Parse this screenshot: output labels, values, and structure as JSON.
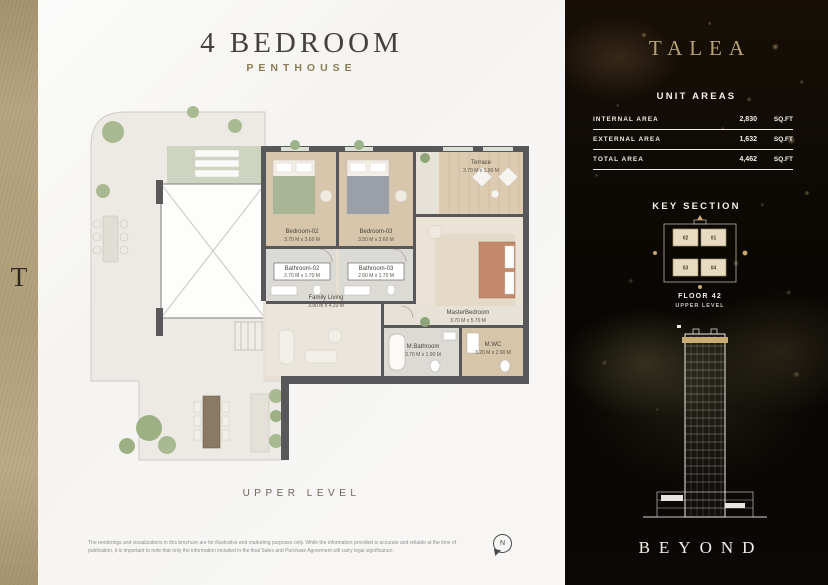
{
  "strip": {
    "letter": "T"
  },
  "main": {
    "title": "4 BEDROOM",
    "subtitle": "PENTHOUSE",
    "level_label": "UPPER LEVEL",
    "compass_label": "N",
    "disclaimer": "The renderings and visualizations in this brochure are for illustrative and marketing purposes only. While the information provided is accurate and reliable at the time of publication, it is important to note that only the information included in the final Sales and Purchase Agreement will carry legal significance."
  },
  "floor_plan": {
    "rooms": [
      {
        "name": "Terrace",
        "dims": "3.70 M x 1.90 M"
      },
      {
        "name": "Bedroom-02",
        "dims": "3.70 M x 3.60 M"
      },
      {
        "name": "Bedroom-03",
        "dims": "3.50 M x 3.60 M"
      },
      {
        "name": "Bathroom-02",
        "dims": "2.70 M x 1.70 M"
      },
      {
        "name": "Bathroom-03",
        "dims": "2.60 M x 1.70 M"
      },
      {
        "name": "MasterBedroom",
        "dims": "3.70 M x 5.70 M"
      },
      {
        "name": "Family Living",
        "dims": "3.90 M x 4.20 M"
      },
      {
        "name": "M.Bathroom",
        "dims": "3.70 M x 1.90 M"
      },
      {
        "name": "M.WC",
        "dims": "3.20 M x 2.90 M"
      }
    ]
  },
  "panel": {
    "brand": "TALEA",
    "unit_areas": {
      "title": "UNIT AREAS",
      "rows": [
        {
          "label": "INTERNAL AREA",
          "value": "2,830",
          "unit": "SQ.FT"
        },
        {
          "label": "EXTERNAL AREA",
          "value": "1,632",
          "unit": "SQ.FT"
        },
        {
          "label": "TOTAL AREA",
          "value": "4,462",
          "unit": "SQ.FT"
        }
      ]
    },
    "key_section": {
      "title": "KEY SECTION",
      "units": [
        "02",
        "01",
        "03",
        "04"
      ],
      "floor_label": "FLOOR 42",
      "level_label": "UPPER LEVEL"
    },
    "footer_brand": "BEYOND",
    "accent_gold": "#b6a373"
  }
}
